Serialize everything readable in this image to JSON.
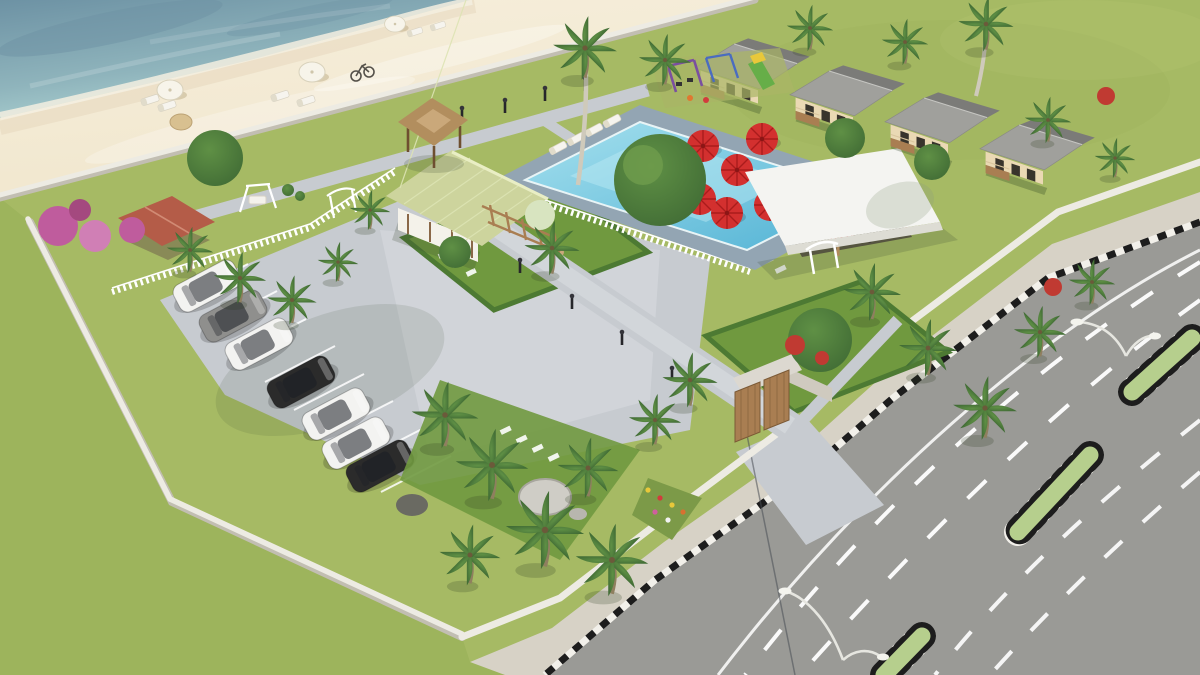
{
  "scene": {
    "title": "Beachfront resort — aerial 3D architectural rendering",
    "type": "3d-architectural-render",
    "view": "high-angle aerial / bird's eye",
    "setting": [
      "ocean",
      "sandy beach",
      "walled resort compound",
      "multi-lane highway with green median"
    ]
  },
  "palette": {
    "ocean_deep": "#6d92a4",
    "ocean_mid": "#8fb4bc",
    "ocean_shallow": "#b2d8d6",
    "sand": "#f1e7ce",
    "sand_wet": "#e4d3ba",
    "grass_outer": "#9db45c",
    "grass_field": "#a6ba64",
    "grass_lawn": "#70993f",
    "hedge": "#4d7a33",
    "pavement": "#c7cbd0",
    "pavement_light": "#d7dbdf",
    "road": "#9a9a96",
    "sidewalk": "#d7d2c6",
    "wall": "#edebe3",
    "wall_shade": "#c2beb2",
    "pool_water": "#51b2d4",
    "pool_light": "#a5e0ee",
    "pool_deck": "#93a5b3",
    "umbrella_red": "#d3302f",
    "umbrella_white": "#f7f4ea",
    "roof_gray": "#a0a09c",
    "roof_gray_dark": "#7b7b78",
    "roof_thatch": "#cdd49d",
    "roof_gazebo": "#b28e5e",
    "roof_terracotta": "#b45c48",
    "roof_white": "#f4f4f1",
    "wall_cream": "#ead9b4",
    "wood": "#a97e52",
    "wood_dark": "#6e4f30",
    "palm_green": "#416c35",
    "palm_light": "#5f9045",
    "bougainvillea": "#bf5c9d",
    "flower_red": "#c03a32",
    "median_green": "#b6cf8d",
    "car_white": "#f3f3f1",
    "car_gray": "#8f8f8d",
    "car_dark": "#2b2b2b",
    "metal": "#e6e6e0"
  },
  "elements": {
    "beach": {
      "white_umbrellas": 3,
      "sun_loungers": 6,
      "bicycles": 1,
      "driftwood": 1
    },
    "pool_area": {
      "pool_shape": "rectangular with corner extension",
      "water_color": "turquoise",
      "deck": "blue-gray pavers",
      "loungers": 6,
      "white_picket_fence": true
    },
    "dining_terrace": {
      "red_umbrellas": 7,
      "tables_with_chairs": 6
    },
    "pavilion": {
      "roof": "flat white slab",
      "structure": "open-air with wooden posts",
      "striped_daybeds": 3
    },
    "bungalows": {
      "count": 4,
      "roof": "gray gable",
      "walls": "cream with dark windows",
      "porches": true
    },
    "playground": {
      "equipment": [
        "purple swing set",
        "blue swing frame",
        "green slide",
        "spring riders"
      ]
    },
    "reception_buildings": {
      "thatched_hall": 1,
      "thatched_gazebo": 1,
      "wood_pergola": 1
    },
    "garden_features": [
      "bougainvillea bushes",
      "terracotta-roof cabana",
      "white swing bench",
      "white garden arches",
      "round topiary",
      "boulders",
      "flower bed",
      "stepping stones"
    ],
    "parking": {
      "cars": 7,
      "car_colors": [
        "white",
        "gray",
        "white",
        "black",
        "white",
        "white",
        "dark-gray"
      ],
      "stall_markings": 8
    },
    "perimeter": {
      "white_wall": true,
      "picket_fences": 2,
      "entrance_gate": "stone gatehouse with twin wooden doors"
    },
    "road": {
      "carriageways": 2,
      "lanes_per_carriageway": 3,
      "lane_markings": "white dashed",
      "median": "green islands with black-white striped curbs",
      "curb": "black-white striped",
      "streetlights": 2,
      "sidewalk": true,
      "grass_verge": true
    },
    "vegetation": {
      "palm_trees": 24,
      "royal_palms": 2,
      "shade_trees": 6,
      "red_flower_shrubs": 4
    }
  }
}
